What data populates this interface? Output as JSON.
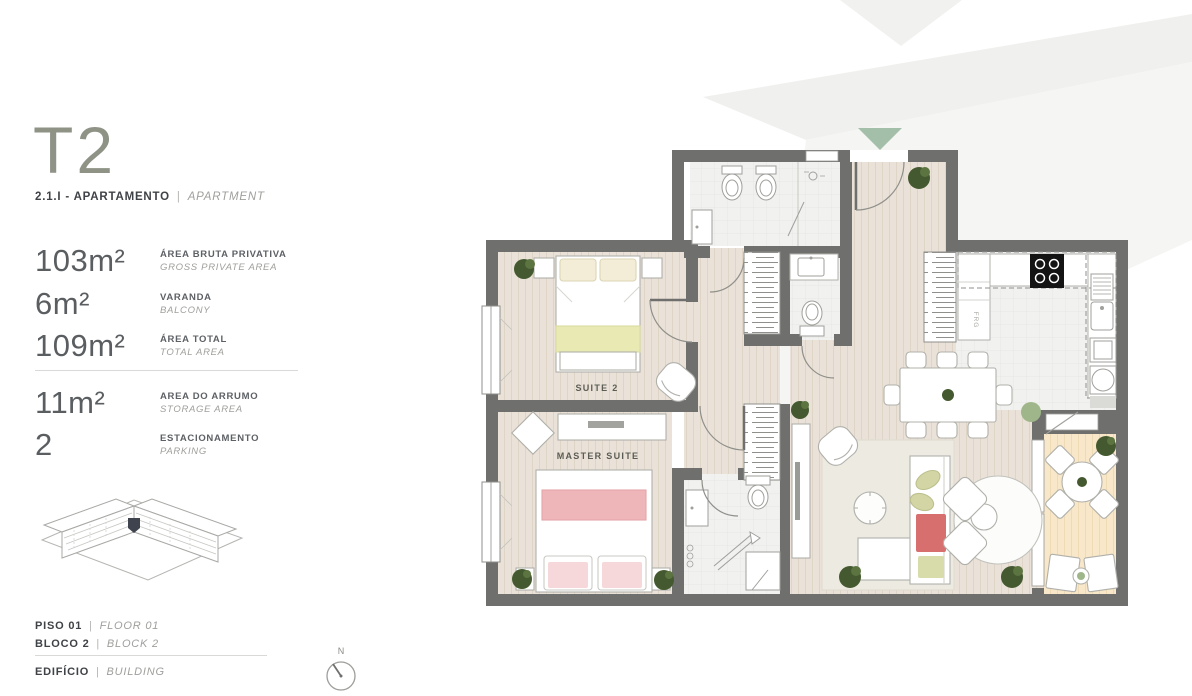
{
  "colors": {
    "wall": "#6f6f6e",
    "wood_floor": "#eae2d8",
    "tile_floor": "#f1f1f0",
    "balcony_floor": "#f8e7c9",
    "accent_yellow_green": "#e9eab3",
    "accent_pink": "#efb6ba",
    "accent_red": "#d86f6f",
    "plant_green": "#44592f",
    "sage_green": "#a3bfaa",
    "title_olive": "#8e9386",
    "text_dark": "#3f4246",
    "text_gray": "#9fa09c",
    "watermark_gray": "#f1f1ef"
  },
  "sidebar": {
    "title": "T2",
    "subtitle": {
      "pt": "2.1.I - APARTAMENTO",
      "sep": "|",
      "en": "APARTMENT"
    },
    "specs": [
      {
        "value": "103m²",
        "label_pt": "ÁREA BRUTA PRIVATIVA",
        "label_en": "GROSS PRIVATE AREA"
      },
      {
        "value": "6m²",
        "label_pt": "VARANDA",
        "label_en": "BALCONY"
      },
      {
        "value": "109m²",
        "label_pt": "ÁREA TOTAL",
        "label_en": "TOTAL AREA"
      },
      {
        "value": "11m²",
        "label_pt": "AREA DO ARRUMO",
        "label_en": "STORAGE AREA"
      },
      {
        "value": "2",
        "label_pt": "ESTACIONAMENTO",
        "label_en": "PARKING"
      }
    ],
    "location": [
      {
        "pt": "PISO 01",
        "sep": "|",
        "en": "FLOOR 01"
      },
      {
        "pt": "BLOCO 2",
        "sep": "|",
        "en": "BLOCK 2"
      }
    ],
    "building_caption": {
      "pt": "EDIFÍCIO",
      "sep": "|",
      "en": "BUILDING"
    }
  },
  "plan": {
    "labels": {
      "suite2": "SUITE 2",
      "master_suite": "MASTER SUITE",
      "fridge": "FRG"
    },
    "compass": {
      "north": "N"
    }
  }
}
